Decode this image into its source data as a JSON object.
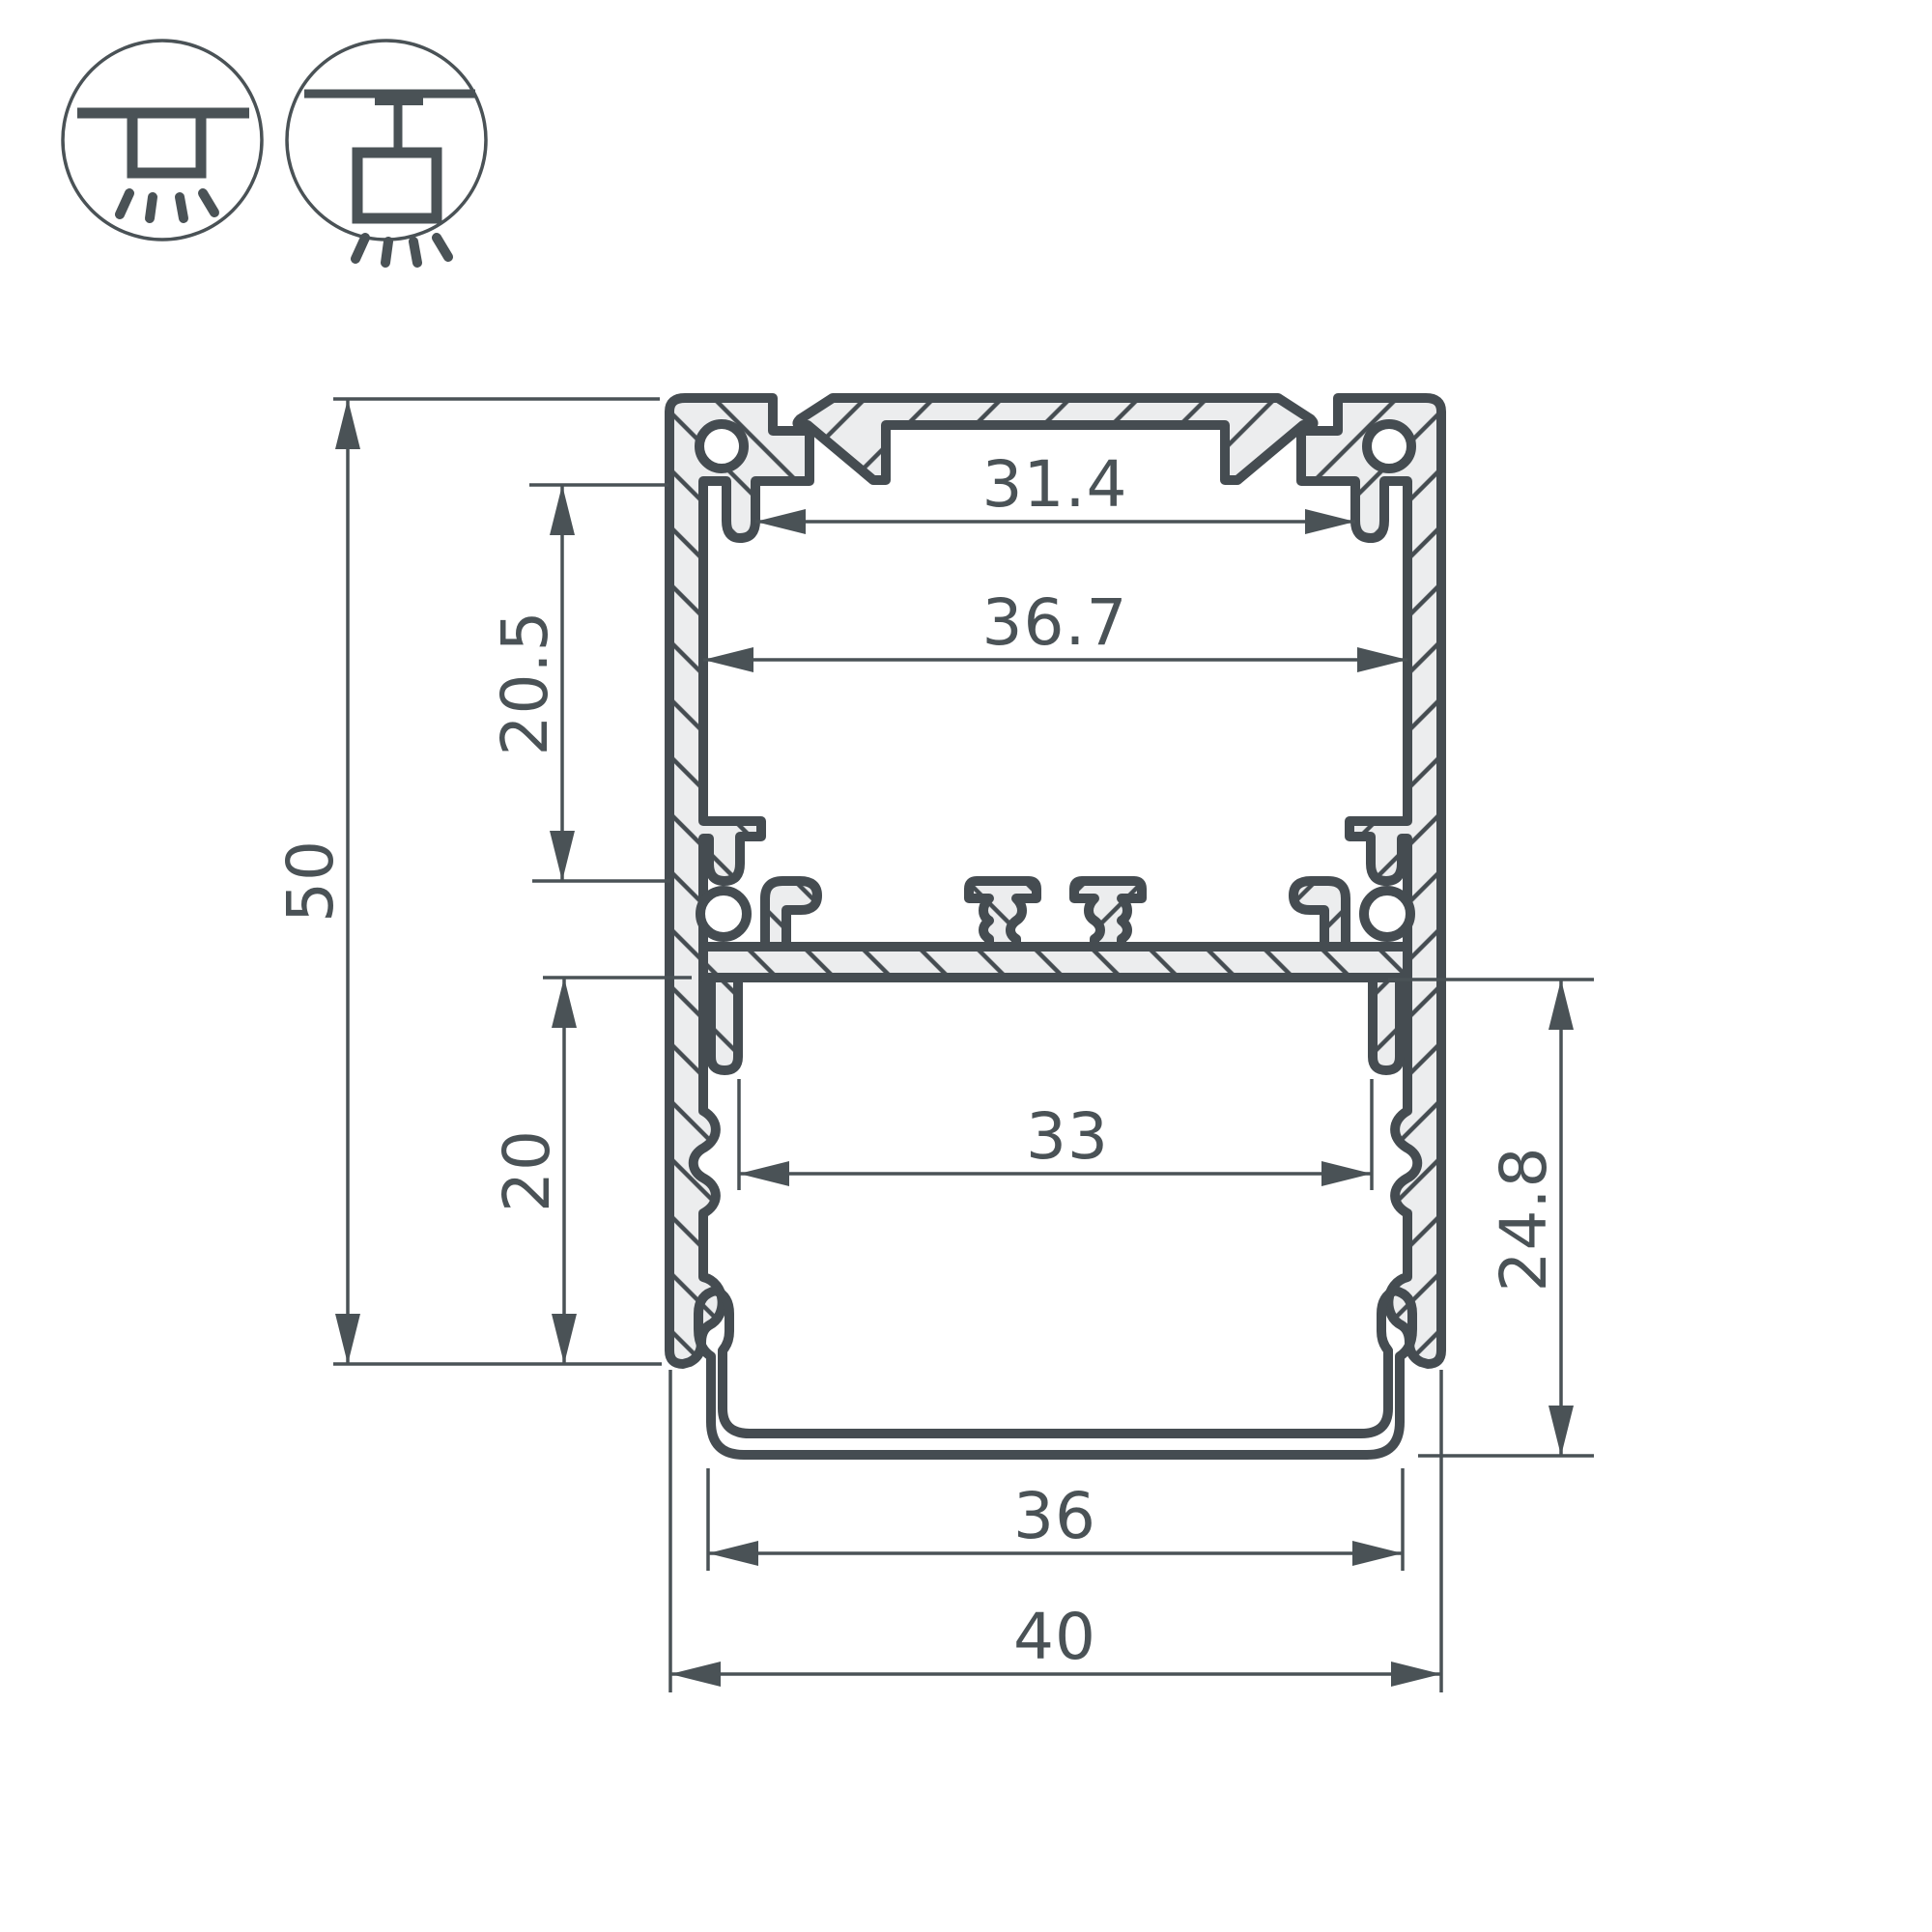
{
  "page": {
    "background": "#ffffff"
  },
  "drawing": {
    "type": "led-profile-cross-section",
    "line_color": "#454c51",
    "dim_color": "#4a5256",
    "body_fill": "#ecedee",
    "icons": [
      {
        "name": "ceiling-surface-mount-icon"
      },
      {
        "name": "ceiling-pendant-mount-icon"
      }
    ],
    "dimensions": {
      "slot_width": {
        "label": "31.4"
      },
      "upper_cavity_width": {
        "label": "36.7"
      },
      "upper_cavity_depth": {
        "label": "20.5"
      },
      "overall_height": {
        "label": "50"
      },
      "lower_cavity_depth": {
        "label": "20"
      },
      "lower_cavity_width": {
        "label": "33"
      },
      "lower_section_height": {
        "label": "24.8"
      },
      "diffuser_width": {
        "label": "36"
      },
      "overall_width": {
        "label": "40"
      }
    }
  }
}
